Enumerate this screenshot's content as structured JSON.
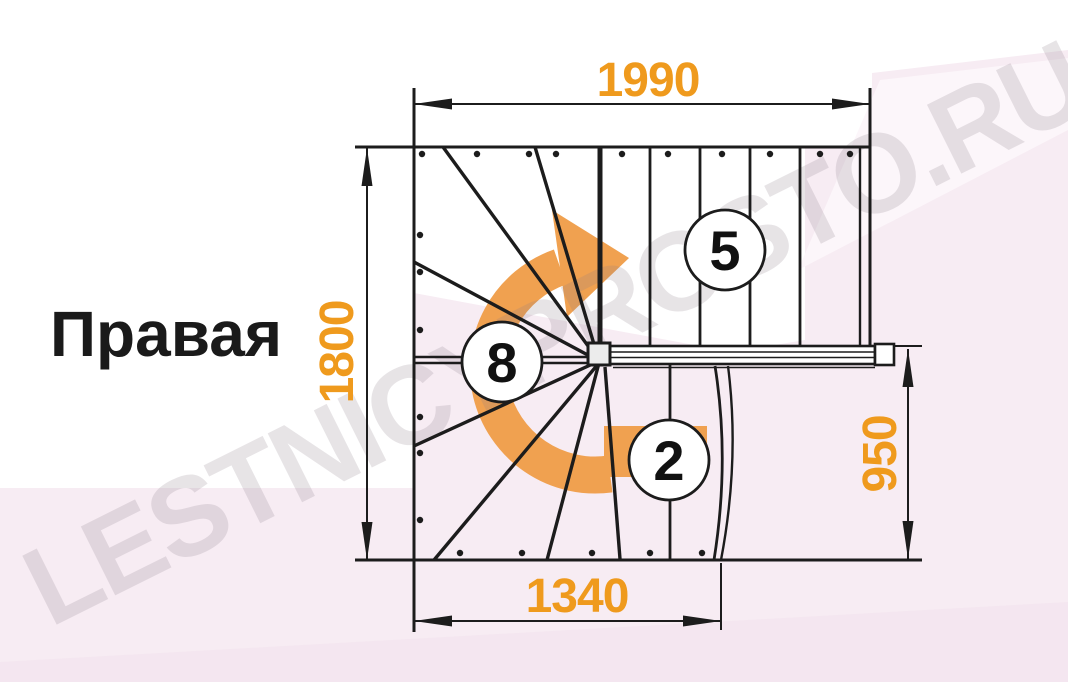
{
  "page": {
    "title_label": "Правая",
    "watermark": "LESTNICYPROSTO.RU"
  },
  "dimensions": {
    "top_width": {
      "value": "1990"
    },
    "left_height": {
      "value": "1800"
    },
    "right_height": {
      "value": "950"
    },
    "bottom_width": {
      "value": "1340"
    }
  },
  "steps": {
    "upper_straight_count": "5",
    "winder_count": "8",
    "lower_straight_count": "2"
  },
  "colors": {
    "accent_orange_text": "#EF9A1D",
    "arrow_orange": "#F0A150",
    "background_pink": "#F7ECF3",
    "background_pink_light": "#FCF6FA",
    "line_black": "#1C1C1C",
    "watermark_gray": "#E9E4E7"
  }
}
